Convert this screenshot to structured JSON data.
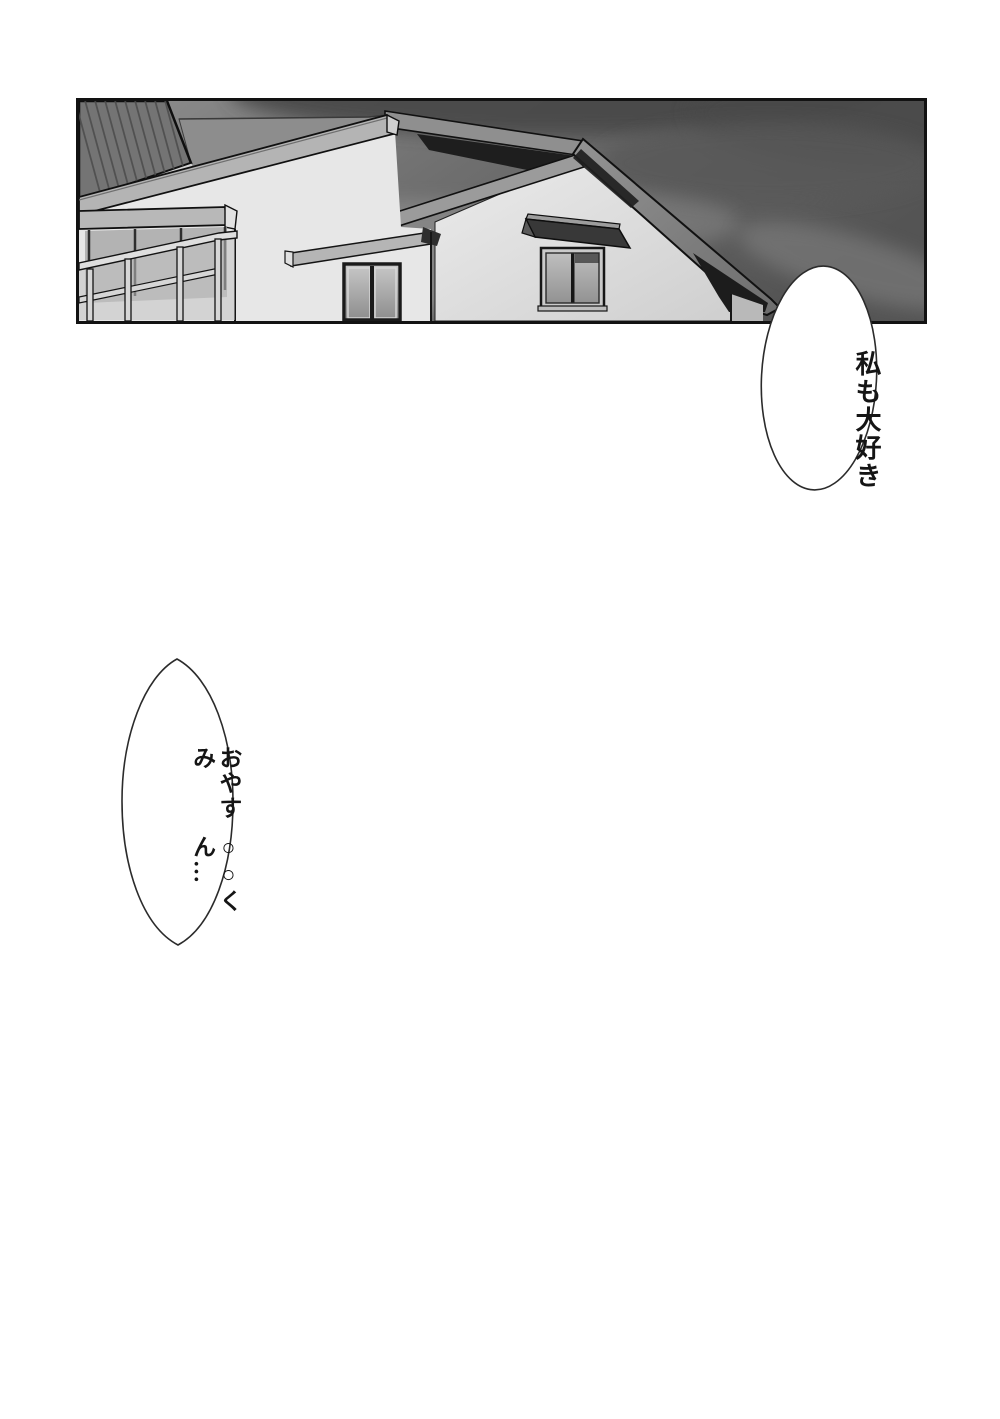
{
  "page": {
    "type": "manga-page",
    "background": "#ffffff",
    "panel_description": "suburban house gables and balcony against a dark overcast evening sky, monochrome"
  },
  "panel": {
    "colors": {
      "sky_light": "#8c8c8c",
      "sky_mid": "#6f6f6f",
      "sky_dark": "#4c4c4c",
      "roof": "#7f7f7f",
      "hatched_roof": "#747474",
      "fascia": "#b4b4b4",
      "wall": "#e7e7e7",
      "glass": "#9e9e9e",
      "shadow": "#1d1d1d",
      "outline": "#111111"
    }
  },
  "balloons": [
    {
      "name": "speech-balloon-1",
      "text": "私も大好き",
      "lines": [
        "私も",
        "大好き"
      ]
    },
    {
      "name": "speech-balloon-2",
      "text": "おやすみ○○くん…",
      "lines": [
        "おやすみ",
        "○○くん…"
      ]
    }
  ]
}
